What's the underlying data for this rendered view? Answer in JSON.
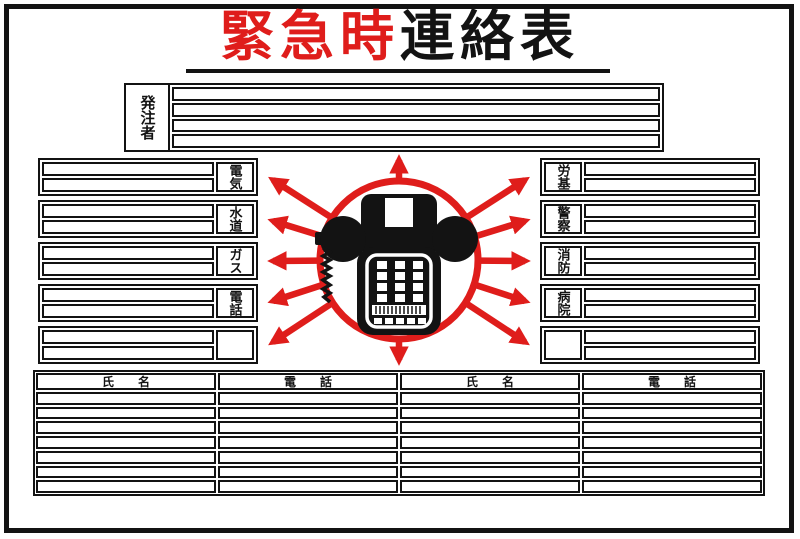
{
  "sign": {
    "colors": {
      "red": "#df1d1b",
      "black": "#131313"
    },
    "title": {
      "red_part": "緊急時",
      "black_part": "連絡表"
    },
    "orderer": {
      "label": "発注者",
      "row_count": 4
    },
    "left_contacts": [
      {
        "label": "電気"
      },
      {
        "label": "水道"
      },
      {
        "label": "ガス"
      },
      {
        "label": "電話"
      },
      {
        "label": ""
      }
    ],
    "right_contacts": [
      {
        "label": "労基"
      },
      {
        "label": "警察"
      },
      {
        "label": "消防"
      },
      {
        "label": "病院"
      },
      {
        "label": ""
      }
    ],
    "center_graphic": {
      "icon": "telephone-icon"
    },
    "directory_table": {
      "headers": [
        "氏　　名",
        "電　　話",
        "氏　　名",
        "電　　話"
      ],
      "row_count": 7
    }
  }
}
